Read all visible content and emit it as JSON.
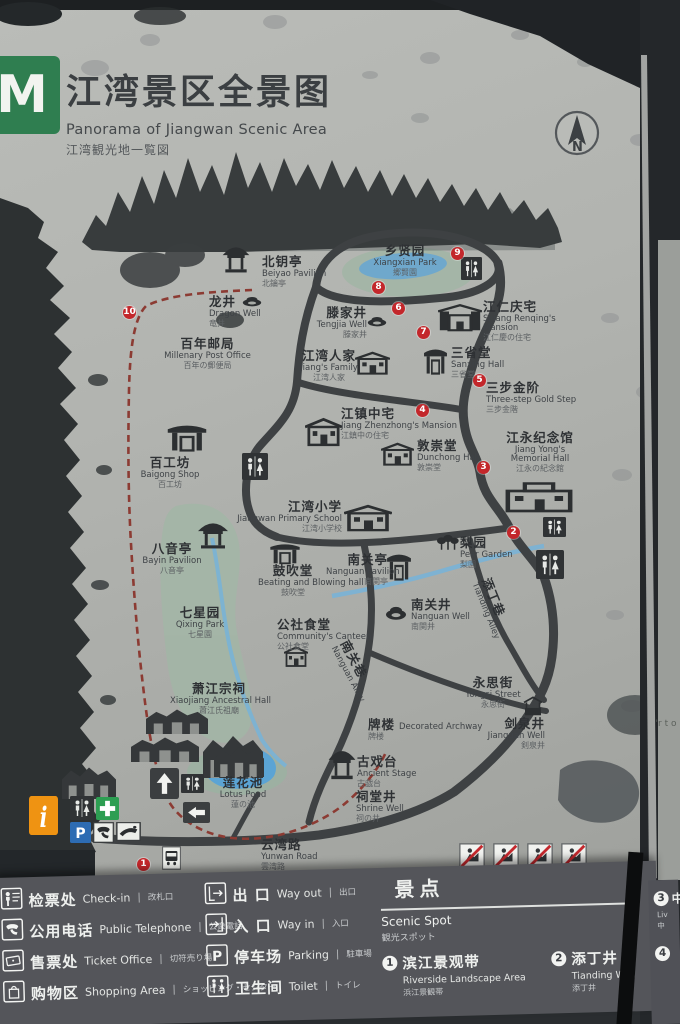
{
  "sign": {
    "logo_letter": "M",
    "title_cn": "江湾景区全景图",
    "title_en": "Panorama of Jiangwan Scenic Area",
    "title_jp": "江湾観光地一覧図",
    "compass_label": "N"
  },
  "colors": {
    "logo_green": "#2f7e50",
    "marker_red": "#c3272b",
    "route_red": "#8c3b33",
    "water_blue": "#6fa8cc",
    "park_green": "#a3b5a6",
    "legend_bg": "#54555a",
    "info_orange": "#ef9312",
    "first_aid_green": "#2d9e52",
    "parking_blue": "#2d6cb3"
  },
  "map": {
    "pois": [
      {
        "id": "beiyao-pavilion",
        "cn": "北钥亭",
        "en": "Beiyao Pavilion",
        "jp": "北鑰亭",
        "x": 262,
        "y": 255
      },
      {
        "id": "xiangxian-park",
        "cn": "乡贤园",
        "en": "Xiangxian Park",
        "jp": "郷賢園",
        "x": 368,
        "y": 244,
        "align": "center",
        "w": 74
      },
      {
        "id": "dragon-well",
        "cn": "龙井",
        "en": "Dragon Well",
        "jp": "竜井",
        "x": 209,
        "y": 295
      },
      {
        "id": "post-office",
        "cn": "百年邮局",
        "en": "Millenary Post Office",
        "jp": "百年の郵便局",
        "x": 150,
        "y": 337,
        "align": "center",
        "w": 115
      },
      {
        "id": "tengjia-well",
        "cn": "滕家井",
        "en": "Tengjia Well",
        "jp": "滕家井",
        "x": 305,
        "y": 306,
        "align": "right",
        "w": 62
      },
      {
        "id": "renqing-mansion",
        "cn": "江仁庆宅",
        "en": "Sijiang Renqing's Mansion",
        "jp": "江仁慶の住宅",
        "x": 483,
        "y": 300,
        "w": 82,
        "wrap": true
      },
      {
        "id": "sanxing-hall",
        "cn": "三省堂",
        "en": "Sanxing Hall",
        "jp": "三省堂",
        "x": 451,
        "y": 346
      },
      {
        "id": "gold-step",
        "cn": "三步金阶",
        "en": "Three-step Gold Step",
        "jp": "三步金階",
        "x": 486,
        "y": 381
      },
      {
        "id": "jiangs-family",
        "cn": "江湾人家",
        "en": "Jiang's Family",
        "jp": "江湾人家",
        "x": 296,
        "y": 349,
        "align": "center",
        "w": 66
      },
      {
        "id": "zhenzhong-mansion",
        "cn": "江镇中宅",
        "en": "Jiang Zhenzhong's Mansion",
        "jp": "江鎮中の住宅",
        "x": 341,
        "y": 407
      },
      {
        "id": "dunchong-hall",
        "cn": "敦崇堂",
        "en": "Dunchong Hall",
        "jp": "敦崇堂",
        "x": 417,
        "y": 439
      },
      {
        "id": "memorial-hall",
        "cn": "江永纪念馆",
        "en": "Jiang Yong's Memorial Hall",
        "jp": "江永の紀念館",
        "x": 505,
        "y": 431,
        "w": 70,
        "wrap": true,
        "align": "center"
      },
      {
        "id": "baigong-shop",
        "cn": "百工坊",
        "en": "Baigong Shop",
        "jp": "百工坊",
        "x": 136,
        "y": 456,
        "align": "center",
        "w": 68
      },
      {
        "id": "primary-school",
        "cn": "江湾小学",
        "en": "Jiangwan Primary School",
        "jp": "江湾小学校",
        "x": 230,
        "y": 500,
        "align": "right",
        "w": 112
      },
      {
        "id": "pear-garden",
        "cn": "梨园",
        "en": "Pear Garden",
        "jp": "梨園",
        "x": 460,
        "y": 536
      },
      {
        "id": "nanguan-pavilion",
        "cn": "南关亭",
        "en": "Nanguan Pavilion",
        "jp": "南関亭",
        "x": 326,
        "y": 553,
        "align": "right",
        "w": 62
      },
      {
        "id": "bayin-pavilion",
        "cn": "八音亭",
        "en": "Bayin Pavilion",
        "jp": "八音亭",
        "x": 138,
        "y": 542,
        "align": "center",
        "w": 68
      },
      {
        "id": "guchui-hall",
        "cn": "鼓吹堂",
        "en": "Beating and Blowing hall",
        "jp": "鼓吹堂",
        "x": 258,
        "y": 564,
        "align": "center",
        "w": 70
      },
      {
        "id": "qixing-park",
        "cn": "七星园",
        "en": "Qixing Park",
        "jp": "七星園",
        "x": 165,
        "y": 606,
        "align": "center",
        "w": 70
      },
      {
        "id": "community-canteen",
        "cn": "公社食堂",
        "en": "Community's Canteen",
        "jp": "公社食堂",
        "x": 277,
        "y": 618
      },
      {
        "id": "nanguan-well",
        "cn": "南关井",
        "en": "Nanguan Well",
        "jp": "南関井",
        "x": 411,
        "y": 598
      },
      {
        "id": "tianding-alley",
        "cn": "添丁巷",
        "en": "Tianding Alley",
        "jp": "",
        "x": 492,
        "y": 576,
        "rot": 68
      },
      {
        "id": "nanguan-alley",
        "cn": "南关巷",
        "en": "Nanguan Alley",
        "jp": "",
        "x": 350,
        "y": 638,
        "rot": 62
      },
      {
        "id": "yongsi-street",
        "cn": "永思街",
        "en": "Yongsi Street",
        "jp": "永思街",
        "x": 462,
        "y": 676,
        "align": "center",
        "w": 62
      },
      {
        "id": "xiaojiang-hall",
        "cn": "萧江宗祠",
        "en": "Xiaojiang Ancestral Hall",
        "jp": "蕭江氏祖廟",
        "x": 170,
        "y": 682,
        "align": "center",
        "w": 98
      },
      {
        "id": "decorated-archway",
        "cn": "牌楼",
        "en": "Decorated Archway",
        "jp": "牌楼",
        "x": 368,
        "y": 715,
        "inline": true
      },
      {
        "id": "jianquan-well",
        "cn": "剑泉井",
        "en": "Jianquan Well",
        "jp": "剣泉井",
        "x": 485,
        "y": 717,
        "align": "right",
        "w": 60
      },
      {
        "id": "ancient-stage",
        "cn": "古戏台",
        "en": "Ancient Stage",
        "jp": "古戯台",
        "x": 357,
        "y": 755
      },
      {
        "id": "shrine-well",
        "cn": "祠堂井",
        "en": "Shrine Well",
        "jp": "祠の井",
        "x": 356,
        "y": 790
      },
      {
        "id": "lotus-pond",
        "cn": "莲花池",
        "en": "Lotus Pond",
        "jp": "蓮の池",
        "x": 212,
        "y": 776,
        "align": "center",
        "w": 62
      },
      {
        "id": "yunwan-road",
        "cn": "云湾路",
        "en": "Yunwan Road",
        "jp": "雲湾路",
        "x": 261,
        "y": 838
      }
    ],
    "icons": [
      {
        "t": "pavilion",
        "x": 220,
        "y": 241,
        "w": 32,
        "h": 34
      },
      {
        "t": "well",
        "x": 241,
        "y": 292,
        "w": 22,
        "h": 16
      },
      {
        "t": "toiletbox",
        "x": 461,
        "y": 257,
        "w": 21,
        "h": 23
      },
      {
        "t": "well",
        "x": 366,
        "y": 312,
        "w": 22,
        "h": 16
      },
      {
        "t": "mansion",
        "x": 438,
        "y": 304,
        "w": 44,
        "h": 30
      },
      {
        "t": "gate",
        "x": 423,
        "y": 344,
        "w": 25,
        "h": 33
      },
      {
        "t": "bldg",
        "x": 355,
        "y": 350,
        "w": 35,
        "h": 27
      },
      {
        "t": "bldg",
        "x": 305,
        "y": 416,
        "w": 37,
        "h": 33
      },
      {
        "t": "bldg",
        "x": 381,
        "y": 441,
        "w": 33,
        "h": 27
      },
      {
        "t": "hall",
        "x": 505,
        "y": 476,
        "w": 68,
        "h": 40
      },
      {
        "t": "gate",
        "x": 166,
        "y": 420,
        "w": 42,
        "h": 34
      },
      {
        "t": "toiletbox",
        "x": 242,
        "y": 453,
        "w": 26,
        "h": 27
      },
      {
        "t": "bldg",
        "x": 344,
        "y": 503,
        "w": 48,
        "h": 31
      },
      {
        "t": "trees",
        "x": 436,
        "y": 534,
        "w": 24,
        "h": 18
      },
      {
        "t": "gate",
        "x": 386,
        "y": 549,
        "w": 26,
        "h": 34
      },
      {
        "t": "pavilion",
        "x": 195,
        "y": 517,
        "w": 36,
        "h": 34
      },
      {
        "t": "gate",
        "x": 269,
        "y": 540,
        "w": 32,
        "h": 26
      },
      {
        "t": "bldg",
        "x": 284,
        "y": 645,
        "w": 24,
        "h": 24
      },
      {
        "t": "well",
        "x": 384,
        "y": 600,
        "w": 24,
        "h": 22
      },
      {
        "t": "toiletbox",
        "x": 543,
        "y": 517,
        "w": 23,
        "h": 20
      },
      {
        "t": "toiletbox",
        "x": 536,
        "y": 550,
        "w": 28,
        "h": 29
      },
      {
        "t": "wellroof",
        "x": 521,
        "y": 696,
        "w": 24,
        "h": 22
      },
      {
        "t": "pavilion",
        "x": 326,
        "y": 744,
        "w": 32,
        "h": 38
      },
      {
        "t": "inkbldg",
        "x": 146,
        "y": 706,
        "w": 62,
        "h": 28
      },
      {
        "t": "inkbldg",
        "x": 131,
        "y": 734,
        "w": 68,
        "h": 28
      },
      {
        "t": "inkbldg",
        "x": 203,
        "y": 730,
        "w": 60,
        "h": 48
      },
      {
        "t": "inkbldg",
        "x": 62,
        "y": 763,
        "w": 54,
        "h": 36
      },
      {
        "t": "inkbldg",
        "x": 214,
        "y": 743,
        "w": 50,
        "h": 34
      },
      {
        "t": "toiletbox",
        "x": 181,
        "y": 774,
        "w": 23,
        "h": 19
      },
      {
        "t": "arrowup",
        "x": 150,
        "y": 768,
        "w": 29,
        "h": 31
      },
      {
        "t": "arrowleft",
        "x": 183,
        "y": 802,
        "w": 27,
        "h": 21
      },
      {
        "t": "infobox",
        "x": 29,
        "y": 796,
        "w": 29,
        "h": 39
      },
      {
        "t": "toiletbox",
        "x": 70,
        "y": 796,
        "w": 24,
        "h": 24
      },
      {
        "t": "crossbox",
        "x": 96,
        "y": 797,
        "w": 23,
        "h": 23
      },
      {
        "t": "pbox",
        "x": 70,
        "y": 822,
        "w": 21,
        "h": 21
      },
      {
        "t": "phonebox",
        "x": 93,
        "y": 822,
        "w": 21,
        "h": 21
      },
      {
        "t": "handbox",
        "x": 116,
        "y": 822,
        "w": 25,
        "h": 19
      },
      {
        "t": "busbox",
        "x": 162,
        "y": 846,
        "w": 19,
        "h": 24
      },
      {
        "t": "probox",
        "x": 459,
        "y": 843,
        "w": 26,
        "h": 26
      },
      {
        "t": "probox",
        "x": 493,
        "y": 843,
        "w": 26,
        "h": 26
      },
      {
        "t": "probox",
        "x": 527,
        "y": 843,
        "w": 26,
        "h": 26
      },
      {
        "t": "probox",
        "x": 561,
        "y": 843,
        "w": 26,
        "h": 26
      }
    ],
    "markers": [
      {
        "n": "10",
        "x": 123,
        "y": 306
      },
      {
        "n": "9",
        "x": 451,
        "y": 247
      },
      {
        "n": "8",
        "x": 372,
        "y": 281
      },
      {
        "n": "6",
        "x": 392,
        "y": 302
      },
      {
        "n": "7",
        "x": 417,
        "y": 326
      },
      {
        "n": "5",
        "x": 473,
        "y": 374
      },
      {
        "n": "4",
        "x": 416,
        "y": 404
      },
      {
        "n": "3",
        "x": 477,
        "y": 461
      },
      {
        "n": "2",
        "x": 507,
        "y": 526
      },
      {
        "n": "1",
        "x": 137,
        "y": 858
      }
    ]
  },
  "legend": {
    "separator": "|",
    "rows_left": [
      {
        "icon": "checkin",
        "cn": "检票处",
        "en": "Check-in",
        "jp": "改札口"
      },
      {
        "icon": "phone",
        "cn": "公用电话",
        "en": "Public Telephone",
        "jp": "公衆電話"
      },
      {
        "icon": "ticket",
        "cn": "售票处",
        "en": "Ticket Office",
        "jp": "切符売り場"
      },
      {
        "icon": "shopping",
        "cn": "购物区",
        "en": "Shopping Area",
        "jp": "ショッピング・センター"
      }
    ],
    "rows_mid": [
      {
        "icon": "wayout",
        "cn": "出 口",
        "en": "Way out",
        "jp": "出口"
      },
      {
        "icon": "wayin",
        "cn": "入 口",
        "en": "Way in",
        "jp": "入口"
      },
      {
        "icon": "parking",
        "cn": "停车场",
        "en": "Parking",
        "jp": "駐車場"
      },
      {
        "icon": "toilet",
        "cn": "卫生间",
        "en": "Toilet",
        "jp": "トイレ"
      }
    ],
    "scenic": {
      "title_cn": "景点",
      "title_en": "Scenic Spot",
      "title_jp": "観光スポット",
      "items": [
        {
          "num": "1",
          "cn": "滨江景观带",
          "en": "Riverside Landscape Area",
          "jp": "浜江景観帯"
        },
        {
          "num": "2",
          "cn": "添丁井",
          "en": "Tianding Well",
          "jp": "添丁井"
        }
      ]
    }
  },
  "adjacent_sign": {
    "side_text": "'r t o",
    "item3_num": "3",
    "item3_text": "中",
    "item3_sub1": "Liv",
    "item3_sub2": "中",
    "item4_num": "4"
  }
}
